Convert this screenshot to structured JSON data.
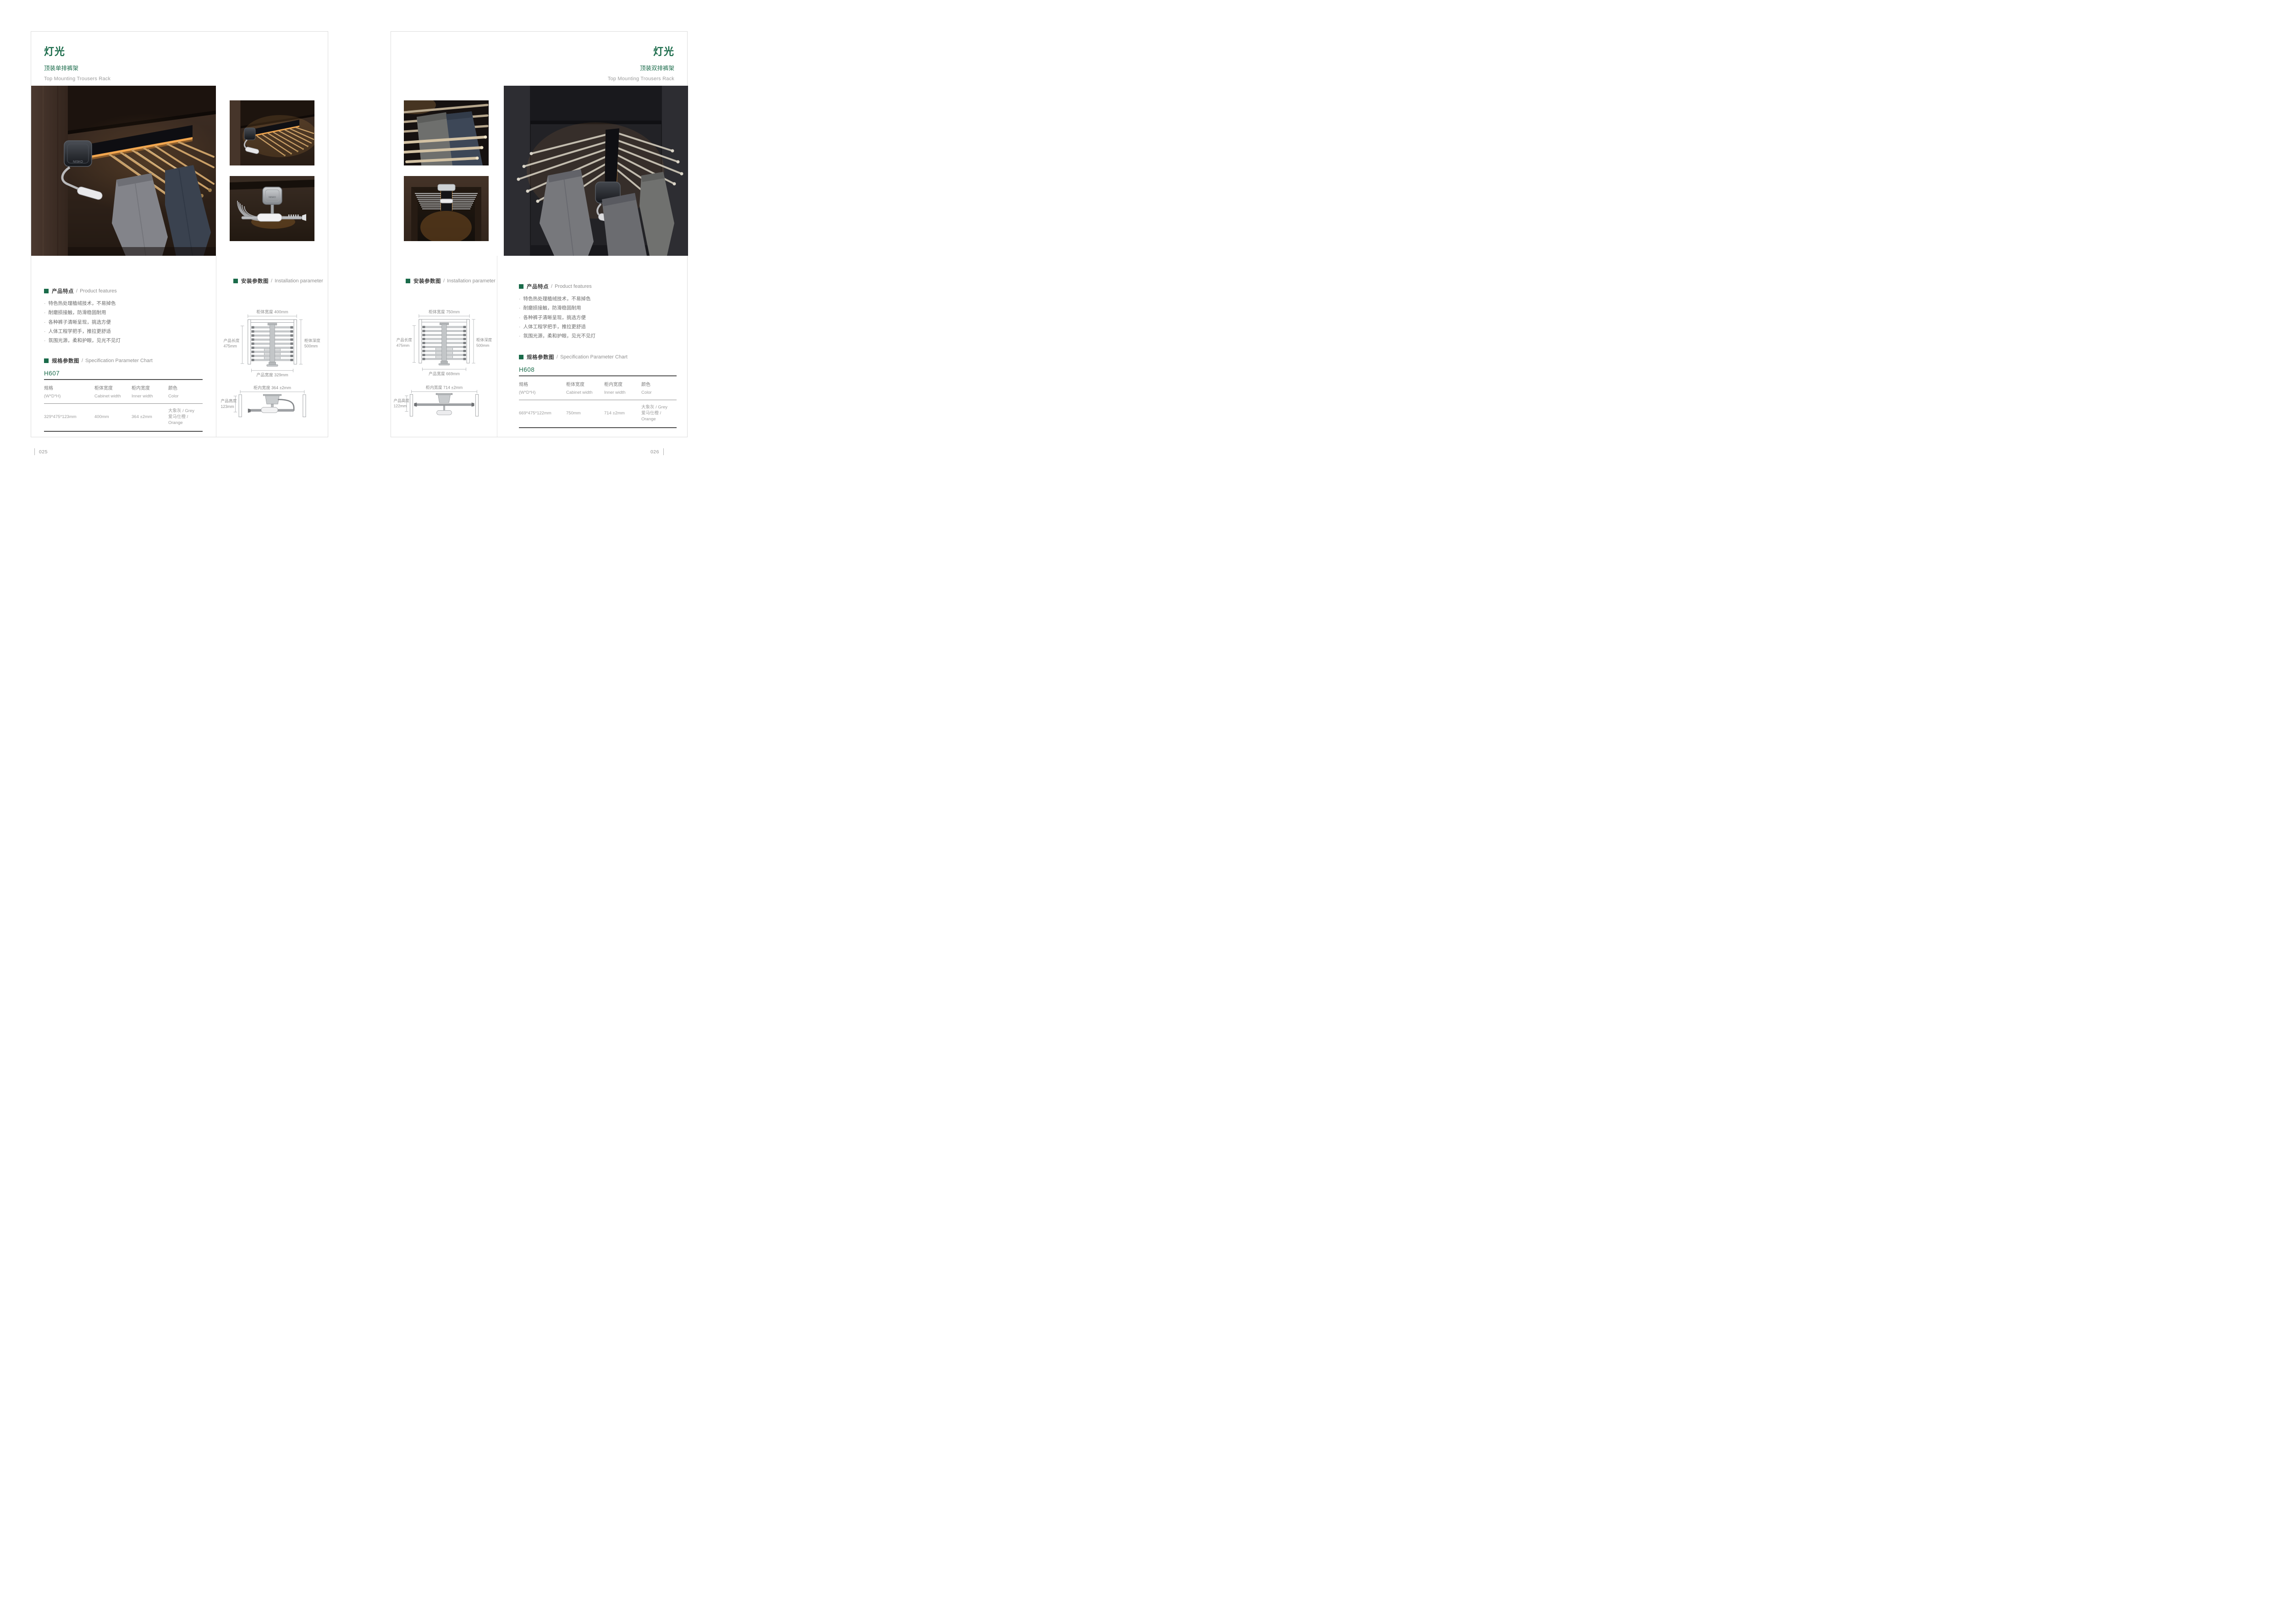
{
  "shared": {
    "sep": "/",
    "bullet": "·",
    "brand_label": "NISKO",
    "colors": {
      "accent_green": "#1a6b4a",
      "glow_orange": "#f2a64e"
    },
    "features_heading": {
      "zh": "产品特点",
      "en": "Product features"
    },
    "spec_heading": {
      "zh": "规格参数图",
      "en": "Specification Parameter Chart"
    },
    "install_heading": {
      "zh": "安装参数图",
      "en": "Installation parameter"
    },
    "feature_items": [
      "特色热处理植绒技术，不易掉色",
      "耐磨损接触，防滑稳固耐用",
      "各种裤子清晰呈现，挑选方便",
      "人体工程学把手，推拉更舒适",
      "氛围光源，柔和护眼，见光不见灯"
    ],
    "spec_columns": [
      {
        "zh": "规格",
        "en": "(W*D*H)"
      },
      {
        "zh": "柜体宽度",
        "en": "Cabinet width"
      },
      {
        "zh": "柜内宽度",
        "en": "Inner width"
      },
      {
        "zh": "颜色",
        "en": "Color"
      }
    ]
  },
  "left_page": {
    "page_number": "025",
    "title": "灯光",
    "subtitle": "顶装单排裤架",
    "subtitle_en": "Top Mounting Trousers Rack",
    "model": "H607",
    "spec_row": {
      "size": "329*475*123mm",
      "cabinet_width": "400mm",
      "inner_width": "364 ±2mm",
      "colors": [
        "大象灰 / Grey",
        "爱马仕橙 / Orange"
      ]
    },
    "plan": {
      "top": "柜体宽度 400mm",
      "left_1": "产品长度",
      "left_2": "475mm",
      "right_1": "柜体深度",
      "right_2": "500mm",
      "bottom": "产品宽度 329mm"
    },
    "front": {
      "top": "柜内宽度 364 ±2mm",
      "left_1": "产品高度",
      "left_2": "123mm"
    }
  },
  "right_page": {
    "page_number": "026",
    "title": "灯光",
    "subtitle": "顶装双排裤架",
    "subtitle_en": "Top Mounting Trousers Rack",
    "model": "H608",
    "spec_row": {
      "size": "669*475*122mm",
      "cabinet_width": "750mm",
      "inner_width": "714 ±2mm",
      "colors": [
        "大象灰 / Grey",
        "爱马仕橙 / Orange"
      ]
    },
    "plan": {
      "top": "柜体宽度 750mm",
      "left_1": "产品长度",
      "left_2": "475mm",
      "right_1": "柜体深度",
      "right_2": "500mm",
      "bottom": "产品宽度 669mm"
    },
    "front": {
      "top": "柜内宽度 714 ±2mm",
      "left_1": "产品高度",
      "left_2": "122mm"
    }
  }
}
